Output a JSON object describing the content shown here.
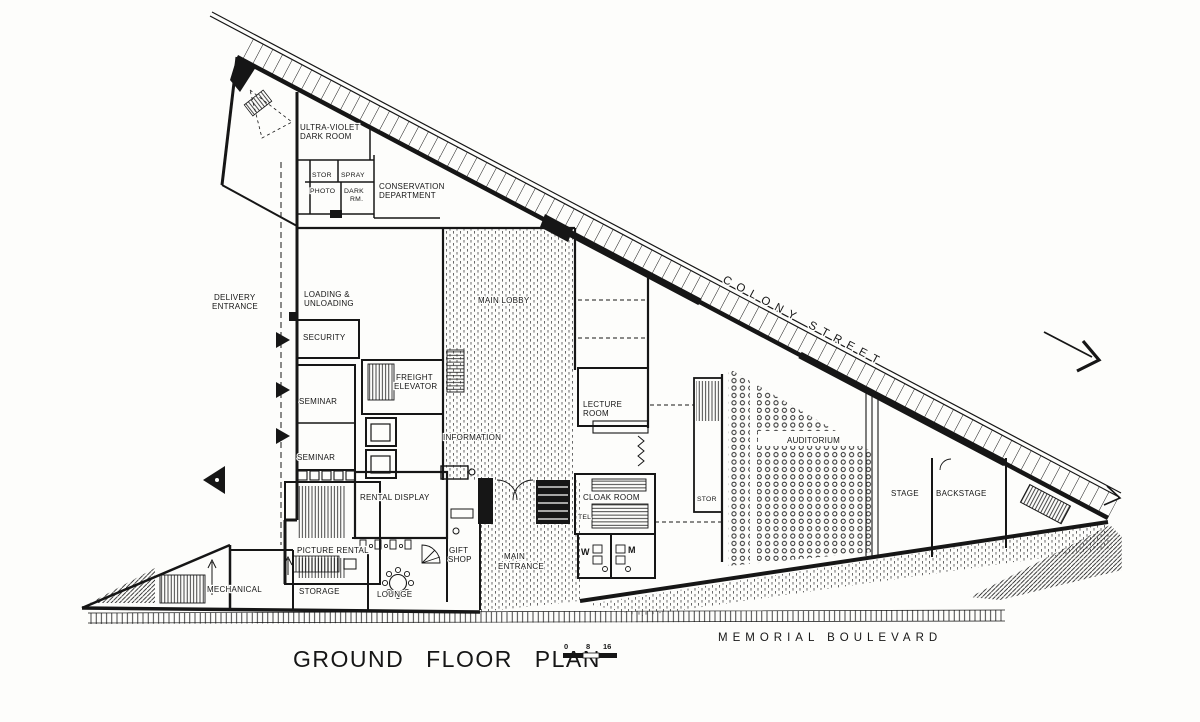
{
  "drawing_title": "GROUND FLOOR PLAN",
  "streets": {
    "colony_street": "COLONY STREET",
    "memorial_boulevard": "MEMORIAL BOULEVARD"
  },
  "scale_bar": {
    "zero": "0",
    "eight": "8",
    "sixteen": "16"
  },
  "rooms": {
    "ultra_violet_line1": "ULTRA-VIOLET",
    "ultra_violet_line2": "DARK ROOM",
    "stor_small": "STOR",
    "spray": "SPRAY",
    "photo": "PHOTO",
    "photo_dark": "DARK",
    "photo_rm": "RM.",
    "conservation_line1": "CONSERVATION",
    "conservation_line2": "DEPARTMENT",
    "delivery_line1": "DELIVERY",
    "delivery_line2": "ENTRANCE",
    "loading_line1": "LOADING &",
    "loading_line2": "UNLOADING",
    "security": "SECURITY",
    "freight_line1": "FREIGHT",
    "freight_line2": "ELEVATOR",
    "seminar_upper": "SEMINAR",
    "seminar_lower": "SEMINAR",
    "main_lobby": "MAIN LOBBY",
    "information": "INFORMATION",
    "rental_display": "RENTAL DISPLAY",
    "picture_rental": "PICTURE RENTAL",
    "mechanical": "MECHANICAL",
    "storage": "STORAGE",
    "lounge": "LOUNGE",
    "gift_line1": "GIFT",
    "gift_line2": "SHOP",
    "main_entrance_line1": "MAIN",
    "main_entrance_line2": "ENTRANCE",
    "cloak_room": "CLOAK ROOM",
    "tel": "TEL",
    "women": "W",
    "men": "M",
    "lecture_line1": "LECTURE",
    "lecture_line2": "ROOM",
    "stor_auditorium": "STOR",
    "auditorium": "AUDITORIUM",
    "stage": "STAGE",
    "backstage": "BACKSTAGE"
  },
  "colors": {
    "ink": "#161616",
    "paper": "#fdfdfb"
  }
}
